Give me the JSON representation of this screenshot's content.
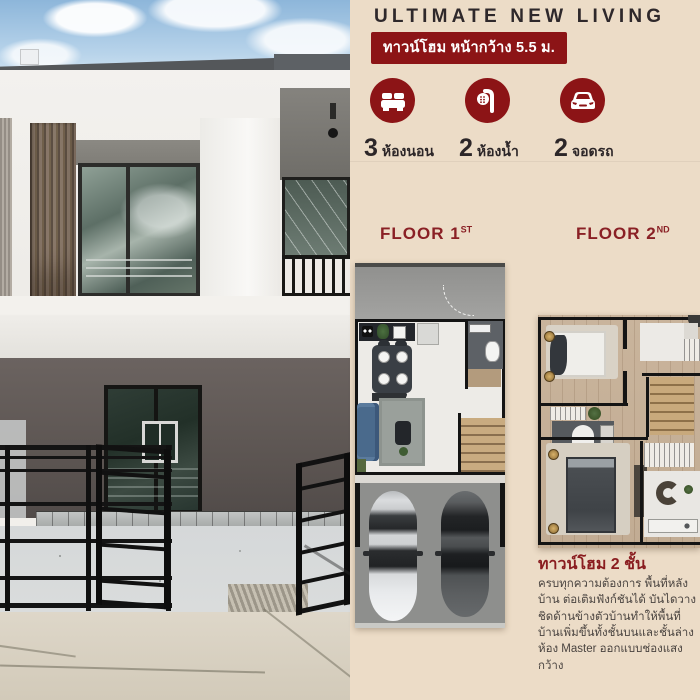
{
  "header": {
    "title": "ULTIMATE NEW LIVING",
    "badge": "ทาวน์โฮม หน้ากว้าง 5.5 ม."
  },
  "stats": [
    {
      "icon": "bed-icon",
      "number": "3",
      "label": "ห้องนอน"
    },
    {
      "icon": "shower-icon",
      "number": "2",
      "label": "ห้องน้ำ"
    },
    {
      "icon": "car-icon",
      "number": "2",
      "label": "จอดรถ"
    }
  ],
  "floors": [
    {
      "label": "FLOOR 1",
      "ordinal": "ST"
    },
    {
      "label": "FLOOR 2",
      "ordinal": "ND"
    }
  ],
  "description": {
    "heading": "ทาวน์โฮม 2 ชั้น",
    "body": "ครบทุกความต้องการ พื้นที่หลังบ้าน ต่อเติมฟังก์ชันได้ บันไดวางชิดด้านข้างตัวบ้านทำให้พื้นที่บ้านเพิ่มขึ้นทั้งชั้นบนและชั้นล่าง ห้อง Master ออกแบบช่องแสงกว้าง"
  },
  "photo": {
    "subject": "two-storey townhouse exterior with black metal gate"
  },
  "colors": {
    "accent_red": "#8c1416",
    "floor_header_red": "#8a2025",
    "panel_background": "#ecdcc7",
    "title_text": "#2e282b",
    "body_text": "#4a4440"
  }
}
